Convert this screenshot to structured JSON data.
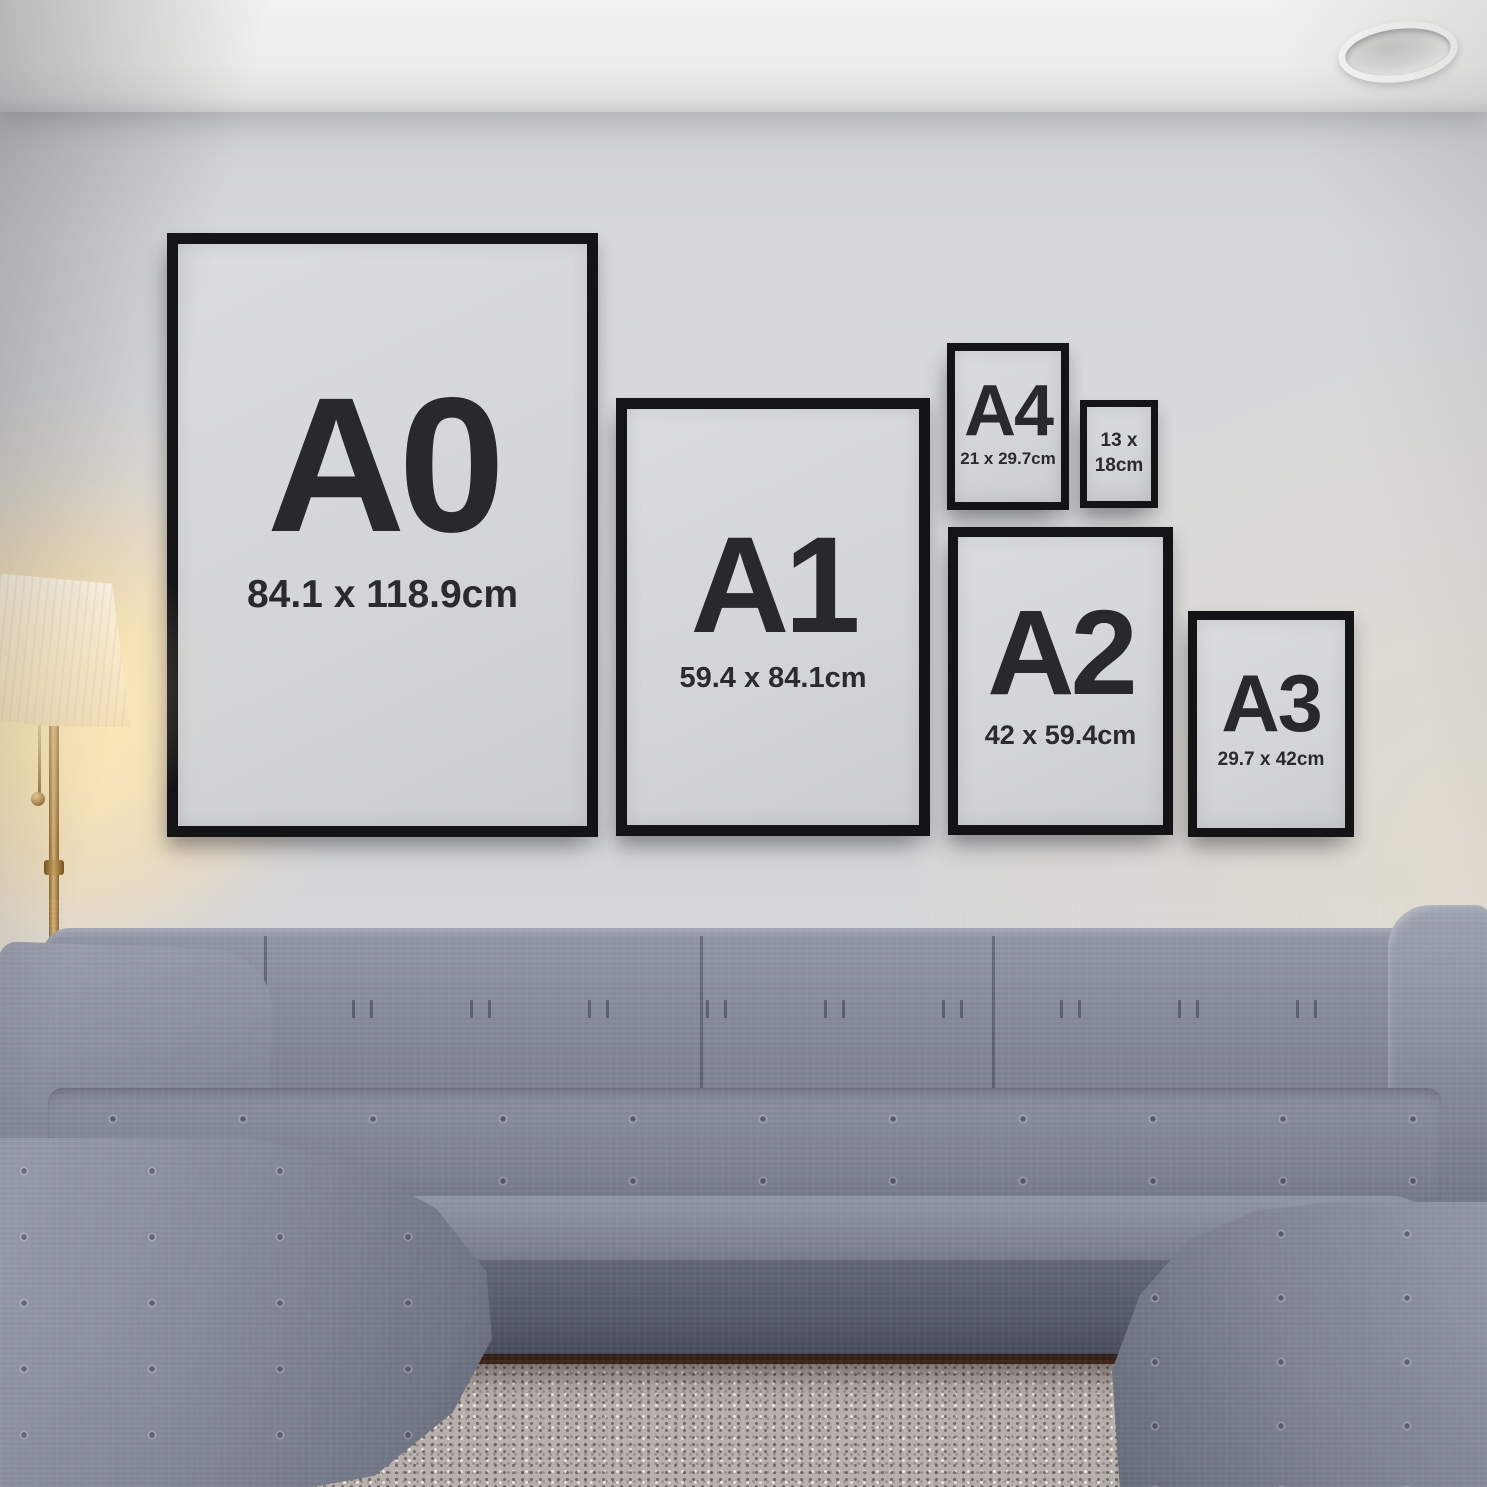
{
  "frames": [
    {
      "name": "A0",
      "label": "A0",
      "dimensions": "84.1 x 118.9cm",
      "dimensions_line2": ""
    },
    {
      "name": "A1",
      "label": "A1",
      "dimensions": "59.4 x 84.1cm",
      "dimensions_line2": ""
    },
    {
      "name": "A4",
      "label": "A4",
      "dimensions": "21 x 29.7cm",
      "dimensions_line2": ""
    },
    {
      "name": "13x18",
      "label": "",
      "dimensions": "13 x",
      "dimensions_line2": "18cm"
    },
    {
      "name": "A2",
      "label": "A2",
      "dimensions": "42 x 59.4cm",
      "dimensions_line2": ""
    },
    {
      "name": "A3",
      "label": "A3",
      "dimensions": "29.7 x 42cm",
      "dimensions_line2": ""
    }
  ],
  "colors": {
    "frame_border": "#141417",
    "frame_paper": "#d4d5d7",
    "label_text": "#29292c",
    "wall": "#d6d7d9",
    "ceiling": "#efefed",
    "sofa": "#7d8292",
    "rug": "#b6aeab",
    "floor_wood": "#3a2317",
    "lamp_glow": "#ffe4aa",
    "lamp_gold": "#b8914f"
  }
}
